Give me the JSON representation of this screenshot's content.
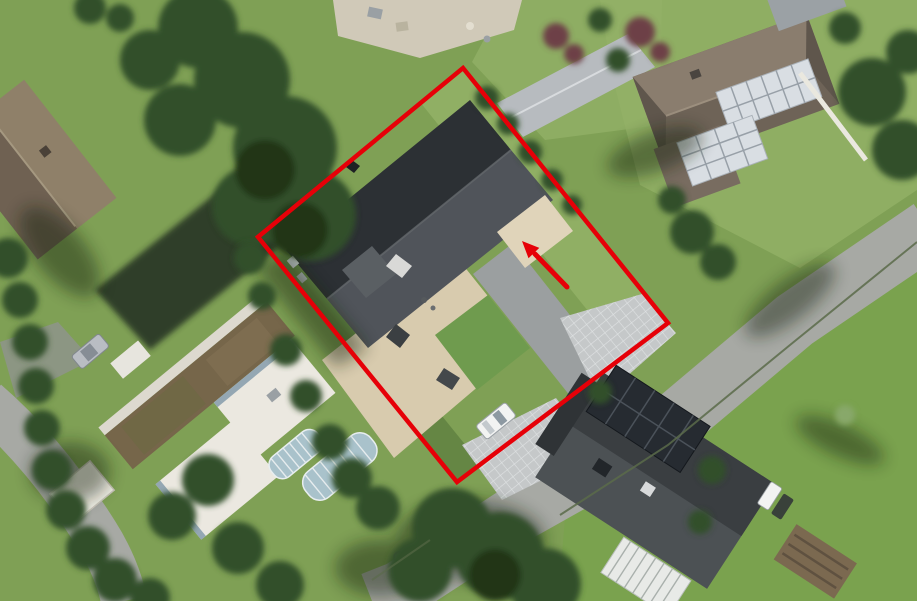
{
  "image": {
    "width": 917,
    "height": 601,
    "viewbox": "0 0 917 601",
    "description": "Aerial satellite view of a residential neighbourhood; one parcel is outlined with a red rotated rectangle and a red arrow points at the house entrance area inside the parcel"
  },
  "annotations": {
    "color": "#e60008",
    "boundary": {
      "shape": "rotated-rectangle",
      "points": "463,68 668,323 457,482 258,237",
      "stroke_width": 4.5
    },
    "arrow": {
      "x1": 567,
      "y1": 287,
      "x2": 535,
      "y2": 254,
      "stroke_width": 5,
      "head_points": "522,241 528.5,258.3 539.3,247.9"
    }
  },
  "scene": {
    "features": [
      "outlined parcel with dark gable-roof house, beige terrace, small lawn, driveway with white car and diamond-paved parking",
      "brown gable-roof house top left",
      "white flat-roof building with brown-green roof strip and silver car on the left",
      "two barrel-shaped pool/greenhouse covers",
      "hip-roof house with white-framed solar panels top right",
      "dark-roof house with black solar panels and white conservatory bottom right",
      "curving grey roads, green meadow on the right, dense tree clusters"
    ]
  },
  "palette": {
    "grass": "#7fa055",
    "grass-light": "#92b066",
    "grass-dark": "#5f8040",
    "meadow": "#7aa24e",
    "tree": "#31502a",
    "tree-dark": "#203619",
    "road": "#a7a9a4",
    "paving": "#d0c9b8",
    "terrace": "#d8cbae",
    "paver": "#c5c8c9",
    "paver-line": "#dfe2e3",
    "roof-dark": "#2c3034",
    "roof-lit": "#50545a",
    "roof-brown-lit": "#8f8069",
    "roof-brown-dark": "#6f6152",
    "roof-tr-lit": "#8a7d6e",
    "roof-tr-dark": "#6e6357",
    "roof-br-lit": "#4c5154",
    "roof-br-dark": "#3a3e41",
    "solar-light": "#d9dee3",
    "solar-dark": "#262b31",
    "flat-roof": "#ebe8e0",
    "green-roof": "#76664a",
    "pool-glass": "#a9c2cb",
    "car-white": "#f2f3f2",
    "car-silver": "#b9bdc3",
    "wall-white": "#eae8df",
    "shadow": "#16240f"
  }
}
